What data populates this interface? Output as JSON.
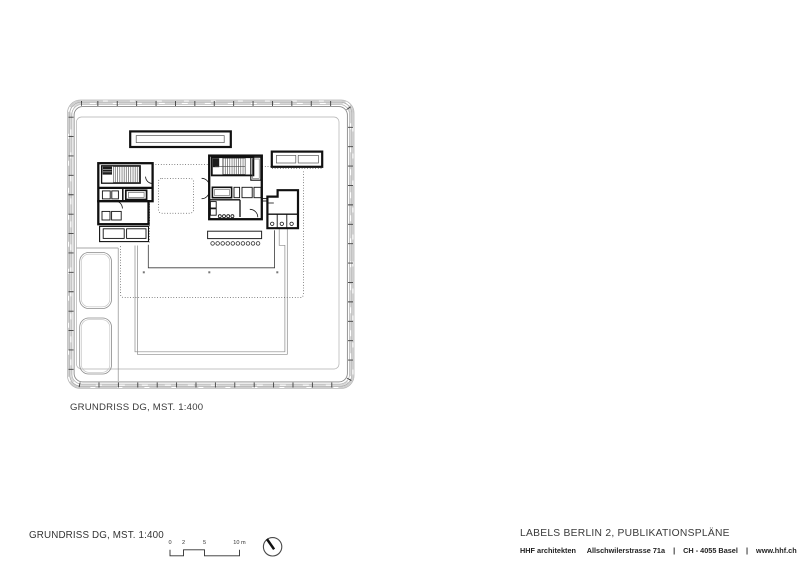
{
  "plan": {
    "caption": "GRUNDRISS DG, MST. 1:400"
  },
  "footer": {
    "left_title": "GRUNDRISS DG, MST. 1:400",
    "scale_bar": {
      "tick_labels": [
        "0",
        "2",
        "5",
        "10 m"
      ]
    },
    "project_title": "LABELS BERLIN 2, PUBLIKATIONSPLÄNE",
    "firm": {
      "name": "HHF architekten",
      "address": "Allschwilerstrasse 71a",
      "separator": "|",
      "city": "CH - 4055 Basel",
      "website": "www.hhf.ch"
    }
  }
}
